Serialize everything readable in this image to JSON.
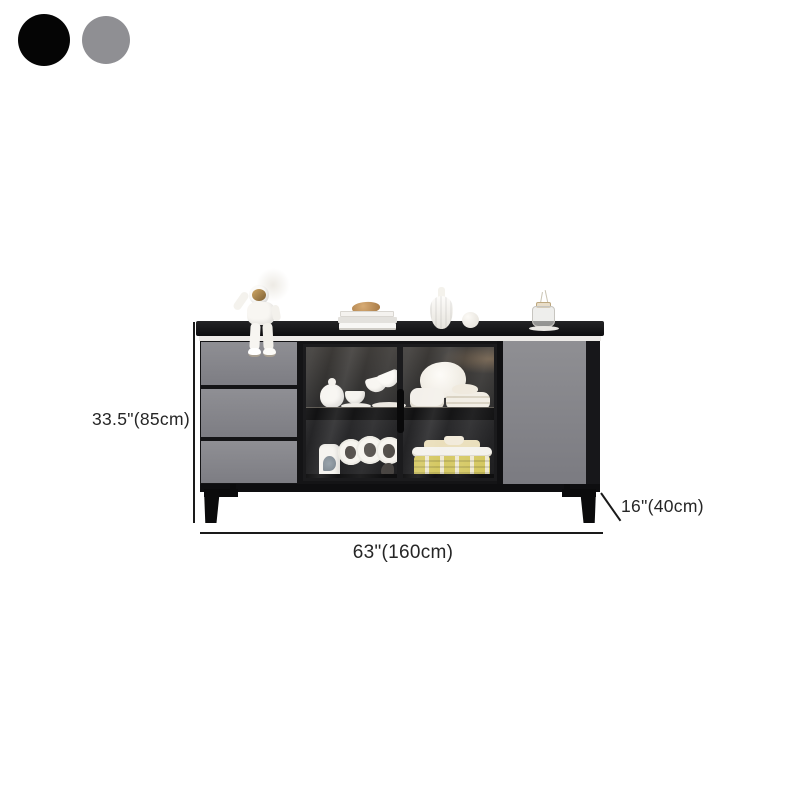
{
  "color_swatches": {
    "items": [
      {
        "name": "black",
        "hex": "#050505"
      },
      {
        "name": "gray",
        "hex": "#8f8f93"
      }
    ]
  },
  "dimensions": {
    "height_label": "33.5\"(85cm)",
    "width_label": "63\"(160cm)",
    "depth_label": "16\"(40cm)"
  },
  "palette": {
    "cabinet_black": "#141416",
    "cabinet_gray": "#87878c",
    "highlight_strip": "#edebe8",
    "basket_yellow": "#d4c75e",
    "visor_gold": "#c79a5b"
  }
}
